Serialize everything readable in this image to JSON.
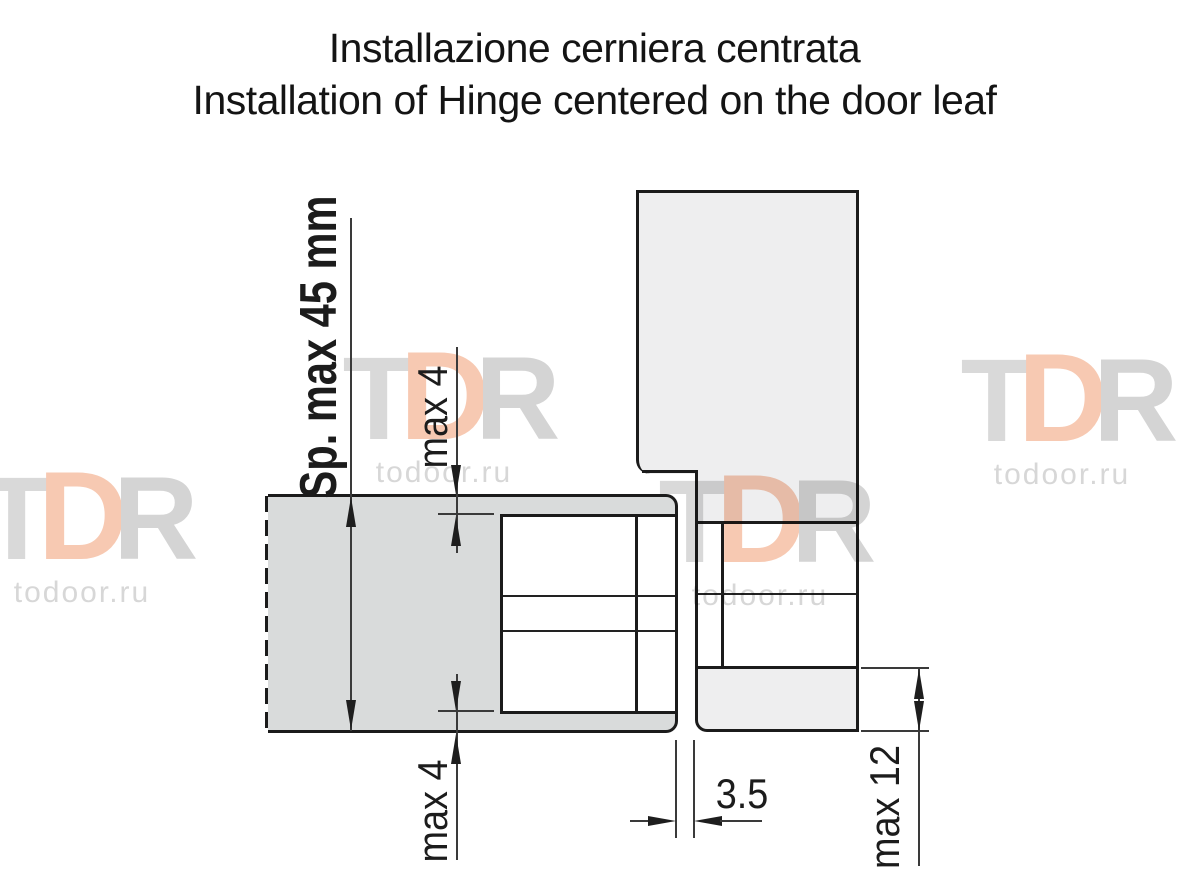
{
  "title": {
    "line1": "Installazione cerniera centrata",
    "line2": "Installation of Hinge centered on the door leaf"
  },
  "dimensions": {
    "door_thickness_label": "Sp. max 45 mm",
    "hinge_top_inset_label": "max 4",
    "hinge_bottom_inset_label": "max 4",
    "door_frame_gap_label": "3.5",
    "frame_overlap_label": "max 12"
  },
  "watermark": {
    "letter_t": "T",
    "letter_d": "D",
    "letter_r": "R",
    "site": "todoor.ru"
  },
  "colors": {
    "door_fill": "#d9dbdb",
    "frame_fill": "#eeeeef",
    "hinge_fill": "#ffffff",
    "outline": "#1b1b1b",
    "dimension": "#3a3a3a",
    "watermark_gray": "#d9d9d9",
    "watermark_salmon": "#f7c9b2"
  }
}
